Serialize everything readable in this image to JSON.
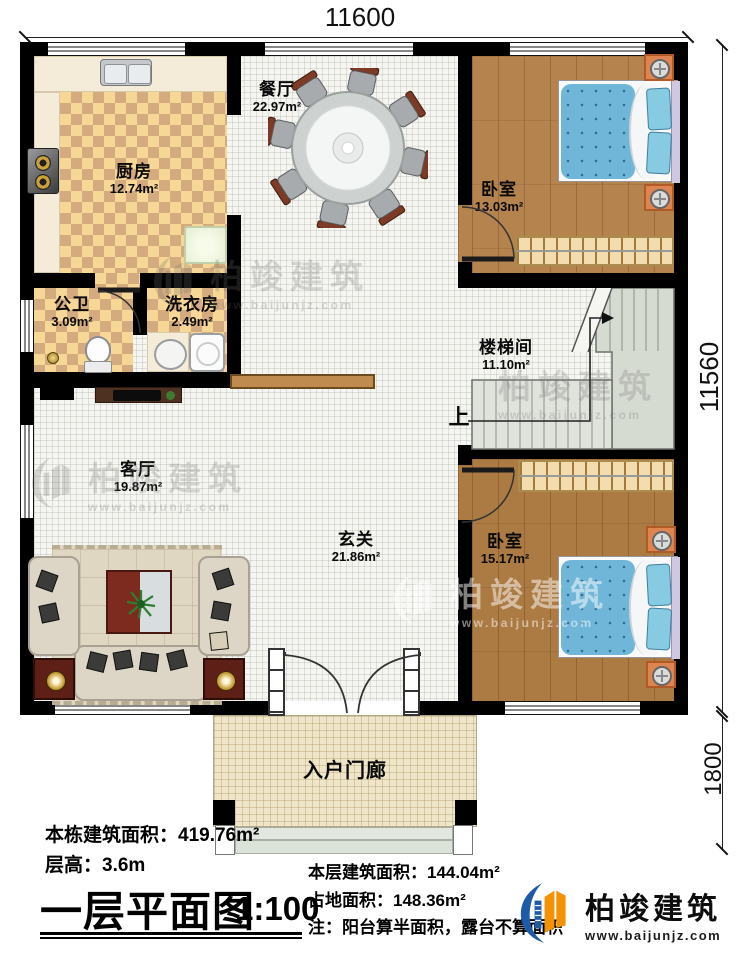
{
  "colors": {
    "wall": "#000000",
    "checker_light": "#f6d795",
    "checker_dark": "#d4ab7e",
    "wood_floor": "#b5834e",
    "tile_floor": "#f5f5f1",
    "stair_gray": "#d6dbd2",
    "bed_blue": "#6fb6d8",
    "nightstand_orange": "#de8450",
    "porch_floor": "#efe6ca",
    "sofa_cream": "#ddd6c6",
    "table_red": "#7d2b1f",
    "logo_blue": "#1d5ba6",
    "logo_orange": "#f29204"
  },
  "dimensions": {
    "top": "11600",
    "side": "11560",
    "porch": "1800"
  },
  "rooms": {
    "dining": {
      "name": "餐厅",
      "area": "22.97m²"
    },
    "kitchen": {
      "name": "厨房",
      "area": "12.74m²"
    },
    "bedroom_top": {
      "name": "卧室",
      "area": "13.03m²"
    },
    "bathroom": {
      "name": "公卫",
      "area": "3.09m²"
    },
    "laundry": {
      "name": "洗衣房",
      "area": "2.49m²"
    },
    "stairwell": {
      "name": "楼梯间",
      "area": "11.10m²"
    },
    "living": {
      "name": "客厅",
      "area": "19.87m²"
    },
    "foyer": {
      "name": "玄关",
      "area": "21.86m²"
    },
    "bedroom_bottom": {
      "name": "卧室",
      "area": "15.17m²"
    },
    "porch": {
      "name": "入户门廊"
    }
  },
  "stairs": {
    "up_label": "上"
  },
  "footer": {
    "stats_left": [
      {
        "label": "本栋建筑面积：",
        "value": "419.76m²"
      },
      {
        "label": "层高：",
        "value": "3.6m"
      }
    ],
    "title": "一层平面图",
    "scale": "1:100",
    "stats_right": [
      {
        "label": "本层建筑面积：",
        "value": "144.04m²"
      },
      {
        "label": "占地面积：",
        "value": "148.36m²"
      },
      {
        "label": "注：",
        "value": "阳台算半面积，露台不算面积"
      }
    ]
  },
  "brand": {
    "name": "柏竣建筑",
    "website": "www.baijunjz.com"
  },
  "watermark": {
    "name": "柏竣建筑",
    "website": "www.baijunjz.com"
  }
}
